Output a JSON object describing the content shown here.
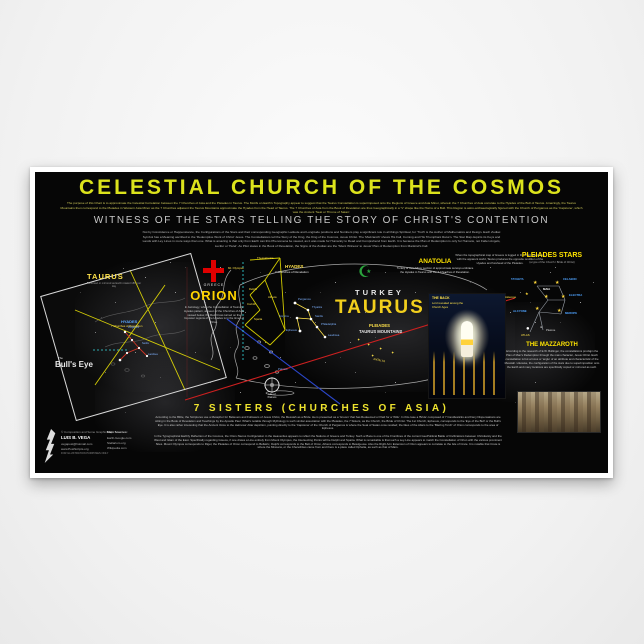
{
  "poster": {
    "title": "CELESTIAL CHURCH OF THE COSMOS",
    "intro_paragraph": "The purpose of this Chart is to approximate the Celestial Correlation between the 7 Churches of Asia and the Pleiades in Taurus. The Motifs on Earth's Topography appear to suggest that the Taurus Constellation is superimposed onto the Regions of Greece and Asia Minor, wherein the 7 Churches of Asia correlate to the Hyades of the Bull of Taurus. Amazingly, the Taurus Mountains then correspond to the Pleiades in Western Asia Minor as the 7 Churches adjacent the Taurus Mountains approximate the Hyades from the Head of Taurus. The 7 Churches of Asia from the Book of Revelation are thus Geographically in a 'V' shape like the Horns of a Bull. This Region is astro-archaeologically figured with the Church of Pergamos as the 'Capstone', which was the Ancient 'Seat or Throne of Satan'.",
    "witness_heading": "WITNESS OF THE STARS TELLING THE STORY OF CHRIST'S CONTENTION",
    "witness_paragraph": "Not by Coincidence or Happenstance, the Configurations of the Stars and their corresponding Geographic Latitude and Longitude positions and Numbers play a significant role in all things Spiritual, for 'Truth' is the Author of Mathematics and Design. Each Zodiac Symbol has a Meaning ascribed to the 'Redemptive Work of Christ' Jesus. The Constellations tell the Story of the King, the King of the Cosmos, Jesus Christ. The 'Mazzaroth' shows His Fall, Coming and His Triumphant Return. The Star Map depicts its Keys and Lands with Ley Lines in more ways than one. What is amazing is that only from Earth can this Phenomena be viewed, as it was made for Humanity to Read and Comprehend from Earth. It is because the Plan of Redemption is only for Humans, not Fallen Angels, Lucifer or 'Helel'. As Pilot states in the Book of Revelation, the Signs of the Zodiac are the 'Silent Witness' to Jesus' Plan of Redemption from Mankind's Fall."
  },
  "inset": {
    "title": "TAURUS",
    "caption": "Reversed or mirrored as Earth rotated 180° per day",
    "hyades_label": "HYADES",
    "churches_label": "7 Churches of Revelation",
    "the": "The",
    "bulls_eye": "Bull's Eye"
  },
  "orion": {
    "country": "GREECE",
    "name": "ORION",
    "paragraph": "In Astrology, when the Constellation of Taurus's Hyades pattern, as seen of the Churches of Asia viewed below, the Red Cross turned on the Imposter regions of the Hyades is in the times of Orion."
  },
  "turkey": {
    "country": "TURKEY",
    "constellation": "TAURUS",
    "pleiades_label": "PLEIADES",
    "mountains_label": "TAURUS MOUNTAINS",
    "antalya": "ANTALYA"
  },
  "anatolia": {
    "title": "ANATOLIA",
    "text": "Turkey or Asia Minor section of approximate surveys embrace the Hyades in Taurus with the 7 Churches of Revelation."
  },
  "note_paragraph": "When the topographical map of Greece is lugged in the chart orientation with the apparent world, Taurus produces the opposite rendition of the Hyades and forehead of the Pleiades.",
  "hyades": {
    "label": "HYADES",
    "sub": "7 Churches of Revelation"
  },
  "churches": [
    "Pergamos",
    "Thyatira",
    "Sardis",
    "Smyrna",
    "Philadelphia",
    "Ephesus",
    "Laodicea"
  ],
  "greece_places": [
    "Thessalonica",
    "Mt. Olympus",
    "Delphi",
    "Athens",
    "Corinth",
    "Sparta"
  ],
  "patmos": "Patmos",
  "compass_caption": "Isle of\nPatmos",
  "christ_panel": {
    "title": "THE BACK",
    "caption": "Lord revealed among the Church Ages"
  },
  "pleiades_panel": {
    "title": "PLEIADES STARS",
    "subtitle": "(a type of the Church / Bride of Christ)",
    "stars": [
      "TAYGETA",
      "CELAENO",
      "ELECTRA",
      "MAIA",
      "Asterope",
      "ALCYONE",
      "MEROPE",
      "ATLAS",
      "Pleione"
    ]
  },
  "mazzaroth": {
    "title": "THE MAZZAROTH",
    "text": "According to the research of E.W. Bullinger, the constellations proclaim the Plan of Man's Redemption through the main character, Jesus Christ. Each constellation is but a focus or 'angle' of an attribute and characteristic of the Messiah. Likewise, the configuration of the stars due to superimposition onto the Earth and many locations are specifically copied or mirrored as such."
  },
  "seven_sisters": {
    "title": "7 SISTERS (CHURCHES OF ASIA)",
    "paragraph_1": "According to the Bible, the Scriptures use a Metaphor for Believers and Followers of Jesus Christ, the Messiah as a Bride. He is presented as a 'Groom' that has Redeemed or Paid for a 'Wife'. In this case a 'Bride' composed of 7 Candlesticks and Fiery Dispensations are sitting in the Book of Revelation and Teachings by the Apostle Paul. What's notable through Mythology is such similar association with the Pleiades, the 7 Sisters, as the Church, the Bride of Christ. The 1st Church, Ephesus, corresponds to the 'Eye of the Bull' or the Bull's Eye. It is also rather interesting that the Ancient Voice to the Hebrews' Altar depiction, pointing directly to the 'Capstone' of the Church of Pergamos is where the Seat of Satan once resided; the likes of the Altars to the 'Blazing Torch' of Orion corresponds to the area of Ephesus.",
    "paragraph_2": "In the Typographical Earthly Reflection of the Cosmos, the Orion-Taurus Configuration in the Heavenlies appears to reflect the Nations of Greece and Turkey. Such a Place is one of the Frontlines of the current GeoPolitical Battle of Civilizations between Christianity and the West and Islam of the East. Specifically regarding Greece, if one draws a Line entirely from Mount Olympus, the Intersecting Points will be Delphi and Sparta. What is remarkable is that such a Ley-Line appears to match the Constellation of Orion with the various prominent Sites. Mount Olympus corresponds to Rigel, the Pleiades of Orion correspond to Bellatrix, Delphi corresponds to the Belt of Orion, Athens corresponds to Betelgeuse. Also the Right Arm Extension of Orion appears to correlate to the Isle of Crete. It is notable that Crete is where the Minoans, or the Cherethites came from and there is a place called Ophelia, as such as that of Mars."
  },
  "credits": {
    "copyright": "© Composition and Some Graphics by",
    "name": "LUIS B. VEGA",
    "email": "vegapost@hotmail.com",
    "website": "www.PostScripts.org",
    "disclaimer": "FOR ILLUSTRATION PURPOSES ONLY",
    "sources_title": "Main Sources:",
    "sources": [
      "Earth-Google.com",
      "Stellarium.org",
      "Wikipedia.com"
    ]
  },
  "colors": {
    "title_yellow": "#dce31c",
    "gold": "#f2cf1d",
    "label_blue": "#7fb2ff",
    "cross_red": "#e00000",
    "crescent_green": "#2aa23c",
    "cyan_line": "#35dbe2",
    "red_line": "#cc2020",
    "blue_line": "#2b46c8"
  }
}
